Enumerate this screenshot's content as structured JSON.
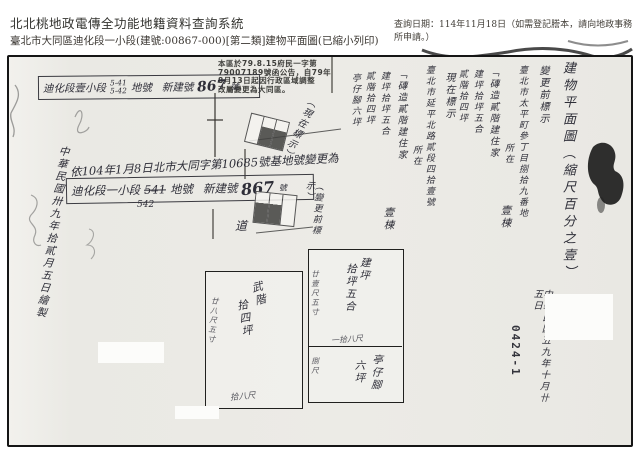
{
  "header": {
    "system_title": "北北桃地政電傳全功能地籍資料查詢系統",
    "query_date": "查詢日期：114年11月18日（如需登記謄本，請向地政事務所申請。）",
    "subtitle": "臺北市大同區迪化段一小段(建號:00867-000)[第二類]建物平面圖(已縮小列印)"
  },
  "scan": {
    "notice": [
      "本區於79.8.15府民一字第",
      "79007189號函公告，自79年",
      "8月13日起因行政區域調整",
      "改屬變更為大同區。"
    ],
    "old_label": {
      "prefix": "迪化段壹小段",
      "lot1": "5-41",
      "lot2": "5-42",
      "mid": "地號",
      "new_no_label": "新建號",
      "no": "867",
      "suffix": "號"
    },
    "annotation": "依104年1月8日北市大同字第10685號基地號變更為",
    "new_label": {
      "prefix": "迪化段一小段",
      "lot": "541",
      "lot_below": "542",
      "mid": "地號",
      "new_no_label": "新建號",
      "no": "867",
      "suffix": "號"
    },
    "left_note": "中華民國卅九年拾貳月五日繪製",
    "current_mark": "（現在標示）",
    "previous_mark": "（變更前標示）",
    "road": "道",
    "plan_title": "建物平面圖（縮尺百分之壹）",
    "form_current": {
      "heading": "現在標示",
      "address": "臺北市延平北路貳段四拾壹號",
      "located": "所在",
      "structure": "「磚造貳階建住家",
      "count": "壹棟",
      "area_main": "建坪拾坪五合",
      "area_floor2": "貳階拾四坪",
      "area_arcade": "亭仔腳六坪"
    },
    "form_previous": {
      "heading": "變更前標示",
      "address": "臺北市太平町參丁目捌拾九番地",
      "located": "所在",
      "structure": "「磚造貳階建住家",
      "count": "壹棟",
      "area_main": "建坪拾坪五合",
      "area_floor2": "貳階拾四坪"
    },
    "plan": {
      "floor2_label1": "武階",
      "floor2_label2": "拾四坪",
      "floor2_side_dim": "廿八尺五寸",
      "floor2_bottom_dim": "拾八尺",
      "main_label1": "建坪",
      "main_label2": "拾坪五合",
      "main_side_dim": "廿壹尺五寸",
      "divider_dim": "一拾八尺",
      "arcade_label": "亭仔腳",
      "arcade_area": "六坪",
      "arcade_side_dim": "捌尺"
    },
    "footer": {
      "date_note": "中華民國五九年十月卄五日",
      "doc_no": "0424-1"
    }
  }
}
